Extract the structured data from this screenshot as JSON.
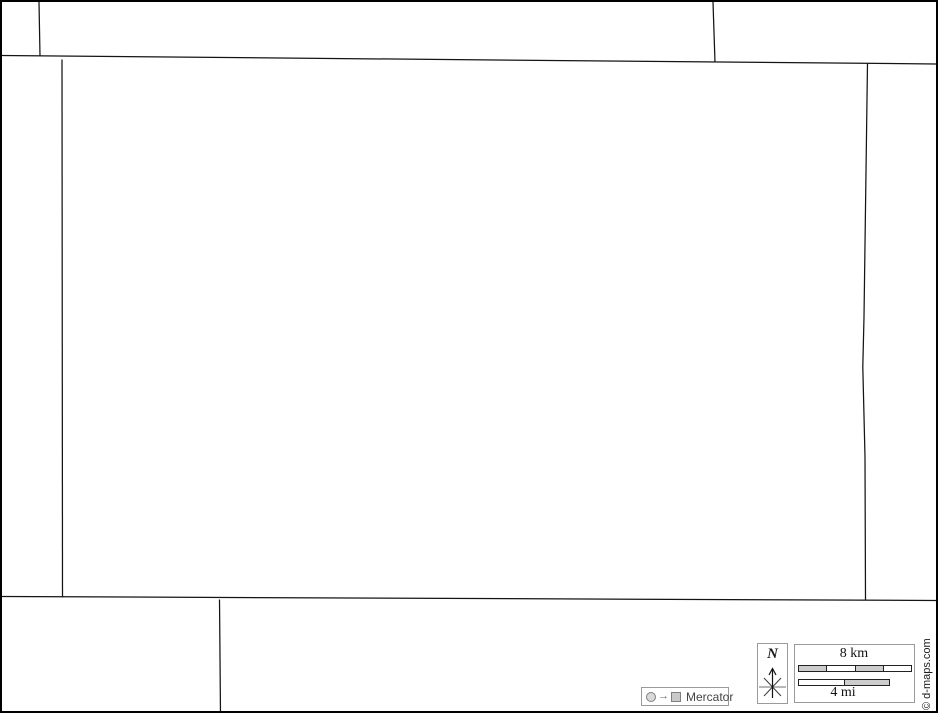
{
  "page": {
    "kind": "blank-outline-map",
    "background_color": "#ffffff",
    "outer_border_color": "#000000",
    "boundary_line_color": "#141414",
    "widget_border_color": "#9a9a9a"
  },
  "map": {
    "central_region": "unlabeled map area",
    "boundaries": [
      "north-boundary-full-width",
      "northwest-small-box-divider",
      "northeast-divider",
      "west-boundary",
      "east-boundary",
      "south-boundary-full-width",
      "southwest-divider"
    ]
  },
  "compass": {
    "north_label": "N",
    "icon": "compass-star-with-north-arrow"
  },
  "scalebar": {
    "km_label": "8 km",
    "mi_label": "4 mi",
    "km_segments": 4,
    "mi_segments": 2,
    "km_segment_fills": [
      "#cccccc",
      "#ffffff",
      "#cccccc",
      "#ffffff"
    ],
    "mi_segment_fills": [
      "#ffffff",
      "#cccccc"
    ],
    "segment_gray": "#cccccc"
  },
  "projection": {
    "label": "Mercator",
    "arrow_glyph": "→",
    "globe_icon": "circle-outline-gray",
    "map_icon": "square-outline-gray"
  },
  "copyright": {
    "text": "© d-maps.com"
  }
}
